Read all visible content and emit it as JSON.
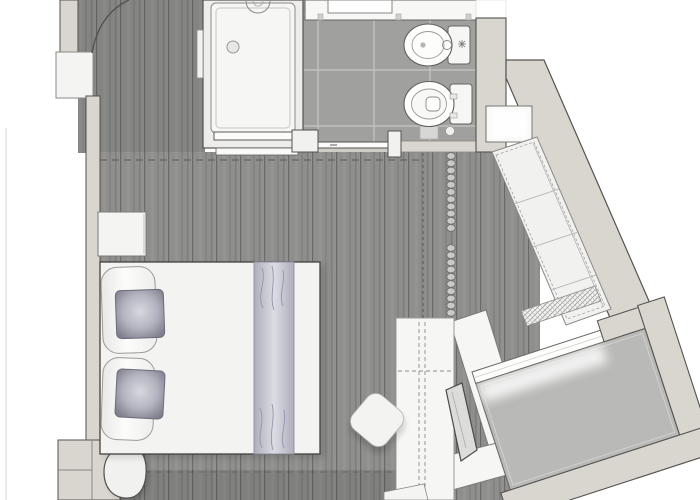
{
  "meta": {
    "title": "Room floor plan",
    "description": "Top-down architectural floor plan of a studio hotel room: entry corridor with entrance door swing, shower enclosure, bathroom with vanity sink, bidet and toilet behind a sliding door, bedroom with double bed, decor cushions, bed runner and nightstand, curtain divider, built-in sofa along an angled wall with a wall niche, wardrobe with hanging rail, media panel, window-side desk, ottoman chair, lounge chair, and an angled balcony with full-height glazing",
    "canvas": {
      "width": 700,
      "height": 500
    }
  },
  "colors": {
    "page_bg": "#ffffff",
    "wood_floor": "#8e8e8c",
    "wood_plank_line": "#5f5f5d",
    "tile_floor": "#a0a09e",
    "grout": "#cbcbc9",
    "wall_fill": "#d9d6cf",
    "wall_outline": "#55534f",
    "fixture_white": "#f6f6f4",
    "fixture_outline": "#67655f",
    "sofa_white": "#f1f1ef",
    "balcony_floor": "#b9b9b7",
    "glazing_white": "#fdfdfc",
    "cushion_dark": "#7f7f8d",
    "cushion_light": "#d8d8df",
    "runner_edge": "#aeaebc",
    "runner_mid": "#dcdce4",
    "dash_line": "#504e4b"
  },
  "rooms": [
    {
      "id": "entry-corridor",
      "floor": "dark wood planks"
    },
    {
      "id": "bathroom",
      "floor": "grey ceramic tiles"
    },
    {
      "id": "bedroom",
      "floor": "dark wood planks"
    },
    {
      "id": "balcony",
      "floor": "grey screed"
    }
  ],
  "fixtures": [
    {
      "id": "entrance-door-swing",
      "room": "entry-corridor"
    },
    {
      "id": "shower-enclosure",
      "room": "bathroom"
    },
    {
      "id": "shower-head",
      "room": "bathroom"
    },
    {
      "id": "vanity-sink",
      "room": "bathroom"
    },
    {
      "id": "bidet",
      "room": "bathroom"
    },
    {
      "id": "toilet",
      "room": "bathroom"
    },
    {
      "id": "sliding-door",
      "room": "bathroom"
    },
    {
      "id": "wall-niche",
      "room": "entry-corridor"
    },
    {
      "id": "niche-shelf",
      "room": "bedroom"
    },
    {
      "id": "built-in-sofa",
      "room": "bedroom"
    },
    {
      "id": "curtain-divider",
      "room": "bedroom"
    },
    {
      "id": "wardrobe",
      "room": "bedroom"
    },
    {
      "id": "media-panel",
      "room": "bedroom"
    },
    {
      "id": "window-desk",
      "room": "bedroom"
    },
    {
      "id": "ottoman-chair",
      "room": "bedroom"
    },
    {
      "id": "lounge-chair",
      "room": "bedroom"
    },
    {
      "id": "double-bed",
      "room": "bedroom"
    },
    {
      "id": "bed-pillows",
      "room": "bedroom"
    },
    {
      "id": "decor-cushions",
      "room": "bedroom"
    },
    {
      "id": "bed-runner",
      "room": "bedroom"
    },
    {
      "id": "nightstand",
      "room": "bedroom"
    },
    {
      "id": "balcony-glazing",
      "room": "balcony"
    },
    {
      "id": "balcony-threshold",
      "room": "balcony"
    }
  ]
}
